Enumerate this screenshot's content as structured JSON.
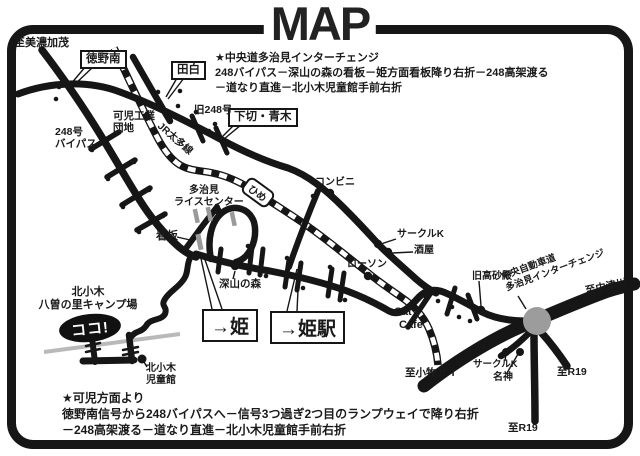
{
  "title": "MAP",
  "notes": {
    "top1": "★中央道多治見インターチェンジ",
    "top2": "248バイパス－深山の森の看板－姫方面看板降り右折－248高架渡る",
    "top3": "－道なり直進－北小木児童館手前右折",
    "bottom1": "★可児方面より",
    "bottom2": "徳野南信号から248バイパスへ－信号3つ過ぎ2つ目のランプウェイで降り右折",
    "bottom3": "－248高架渡る－道なり直進－北小木児童館手前右折"
  },
  "boxed_signs": {
    "tokuno_minami": "徳野南",
    "tashiro": "田白",
    "shimogiri_aoki": "下切・青木",
    "hime": "→姫",
    "hime_station": "→姫駅",
    "hime_rail_sign": "ひめ"
  },
  "labels": {
    "to_minokamo": "至美濃加茂",
    "route_248_bypass_1": "248号",
    "route_248_bypass_2": "バイパス",
    "kani_industrial_1": "可児工業",
    "kani_industrial_2": "団地",
    "jr_taita_line": "JR太多線",
    "old_248": "旧248号",
    "tajimi_rice_center_1": "多治見",
    "tajimi_rice_center_2": "ライスセンター",
    "convenience_store": "コンビニ",
    "circle_k_north": "サークルK",
    "liquor_shop": "酒屋",
    "lawson": "ローソン",
    "signboard": "看板",
    "miyama_no_mori": "深山の森",
    "cats_cafe_1": "Cat's",
    "cats_cafe_2": "Cafe",
    "old_takasagoden": "旧高砂殿",
    "chuo_expressway_1": "中央自動車道",
    "chuo_expressway_2": "多治見インターチェンジ",
    "to_nakatsugawa": "至中津川",
    "camp_1": "北小木",
    "camp_2": "八曽の里キャンプ場",
    "here_marker": "ココ!",
    "jidokan_1": "北小木",
    "jidokan_2": "児童館",
    "to_komaki_jct": "至小牧JCT",
    "circle_k_south": "サークルK",
    "meishin": "名神",
    "to_r19_east": "至R19",
    "to_r19_south": "至R19"
  },
  "colors": {
    "ink": "#1a1a1a",
    "interchange_gray": "#9c9c9c",
    "river_gray": "#b9b9b9",
    "signbar_gray": "#9a9a9a",
    "background": "#ffffff"
  }
}
